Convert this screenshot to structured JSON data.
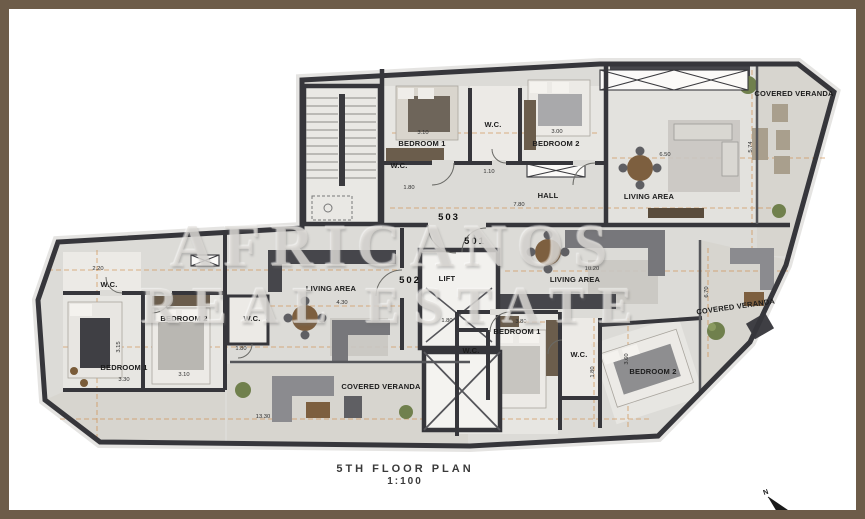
{
  "title": {
    "line1": "5TH FLOOR PLAN",
    "line2": "1:100"
  },
  "watermark": {
    "line1": "AFRICANOS",
    "line2": "REAL ESTATE"
  },
  "compass": {
    "label": "N"
  },
  "colors": {
    "frame": "#6d5c49",
    "wall": "#36363b",
    "floor": "#dcdbd7",
    "room": "#e7e6e2",
    "veranda": "#d7d5cf",
    "dimension_line": "#cf8c4a",
    "wood": "#7d5f3f",
    "label_text": "#1c1c1c"
  },
  "unit_labels": [
    {
      "text": "503",
      "x": 449,
      "y": 220
    },
    {
      "text": "501",
      "x": 475,
      "y": 244
    },
    {
      "text": "502",
      "x": 410,
      "y": 283
    }
  ],
  "room_labels": [
    {
      "text": "BEDROOM 1",
      "x": 422,
      "y": 146
    },
    {
      "text": "W.C.",
      "x": 493,
      "y": 127
    },
    {
      "text": "BEDROOM 2",
      "x": 556,
      "y": 146
    },
    {
      "text": "W.C.",
      "x": 399,
      "y": 168
    },
    {
      "text": "HALL",
      "x": 548,
      "y": 198
    },
    {
      "text": "LIVING AREA",
      "x": 649,
      "y": 199
    },
    {
      "text": "COVERED VERANDA",
      "x": 794,
      "y": 96
    },
    {
      "text": "LIVING AREA",
      "x": 331,
      "y": 291
    },
    {
      "text": "W.C.",
      "x": 109,
      "y": 287
    },
    {
      "text": "BEDROOM 2",
      "x": 184,
      "y": 321
    },
    {
      "text": "BEDROOM 1",
      "x": 124,
      "y": 370
    },
    {
      "text": "W.C.",
      "x": 252,
      "y": 321
    },
    {
      "text": "COVERED VERANDA",
      "x": 381,
      "y": 389
    },
    {
      "text": "LIVING AREA",
      "x": 575,
      "y": 282
    },
    {
      "text": "BEDROOM 1",
      "x": 517,
      "y": 334
    },
    {
      "text": "W.C.",
      "x": 471,
      "y": 353
    },
    {
      "text": "W.C.",
      "x": 579,
      "y": 357
    },
    {
      "text": "BEDROOM 2",
      "x": 653,
      "y": 374
    },
    {
      "text": "COVERED VERANDA",
      "x": 736,
      "y": 309
    },
    {
      "text": "LIFT",
      "x": 447,
      "y": 281
    }
  ],
  "dim_labels": [
    {
      "text": "3.10",
      "x": 423,
      "y": 134,
      "rot": 0
    },
    {
      "text": "3.00",
      "x": 557,
      "y": 133,
      "rot": 0
    },
    {
      "text": "1.80",
      "x": 409,
      "y": 189,
      "rot": 0
    },
    {
      "text": "1.10",
      "x": 489,
      "y": 173,
      "rot": 0
    },
    {
      "text": "7.80",
      "x": 519,
      "y": 206,
      "rot": 0
    },
    {
      "text": "6.50",
      "x": 665,
      "y": 156,
      "rot": 0
    },
    {
      "text": "5.74",
      "x": 752,
      "y": 147,
      "rot": -90
    },
    {
      "text": "2.20",
      "x": 98,
      "y": 270,
      "rot": 0
    },
    {
      "text": "3.15",
      "x": 120,
      "y": 347,
      "rot": -90
    },
    {
      "text": "3.30",
      "x": 124,
      "y": 381,
      "rot": 0
    },
    {
      "text": "3.10",
      "x": 184,
      "y": 376,
      "rot": 0
    },
    {
      "text": "1.80",
      "x": 241,
      "y": 350,
      "rot": 0
    },
    {
      "text": "4.30",
      "x": 342,
      "y": 304,
      "rot": 0
    },
    {
      "text": "1.80",
      "x": 447,
      "y": 322,
      "rot": 0
    },
    {
      "text": "10.20",
      "x": 592,
      "y": 270,
      "rot": 0
    },
    {
      "text": "3.80",
      "x": 521,
      "y": 323,
      "rot": 0
    },
    {
      "text": "1.80",
      "x": 594,
      "y": 372,
      "rot": -90
    },
    {
      "text": "3.60",
      "x": 628,
      "y": 359,
      "rot": -90
    },
    {
      "text": "13.30",
      "x": 263,
      "y": 418,
      "rot": 0
    },
    {
      "text": "6.70",
      "x": 708,
      "y": 292,
      "rot": -90
    }
  ]
}
